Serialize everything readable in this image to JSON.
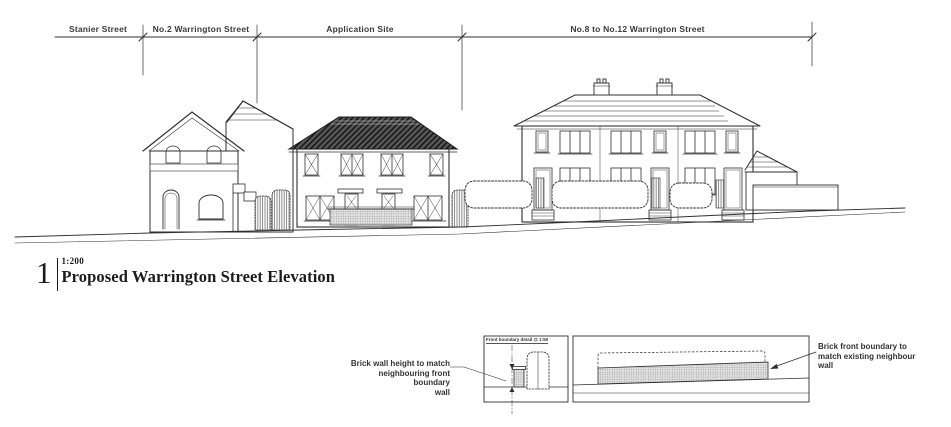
{
  "page": {
    "background": "#ffffff",
    "ink": "#2f2f2f",
    "roof_fill": "#575757"
  },
  "dimension_labels": {
    "segment1": "Stanier Street",
    "segment2": "No.2 Warrington Street",
    "segment3": "Application Site",
    "segment4": "No.8 to No.12 Warrington Street"
  },
  "title_block": {
    "number": "1",
    "scale": "1:200",
    "title": "Proposed Warrington Street Elevation"
  },
  "annotations": {
    "detail_box_label": "Front boundary detail @ 1:50",
    "left": {
      "line1": "Brick wall height to match",
      "line2": "neighbouring front boundary",
      "line3": "wall"
    },
    "right": {
      "line1": "Brick front boundary to",
      "line2": "match existing neighbour",
      "line3": "wall"
    }
  }
}
